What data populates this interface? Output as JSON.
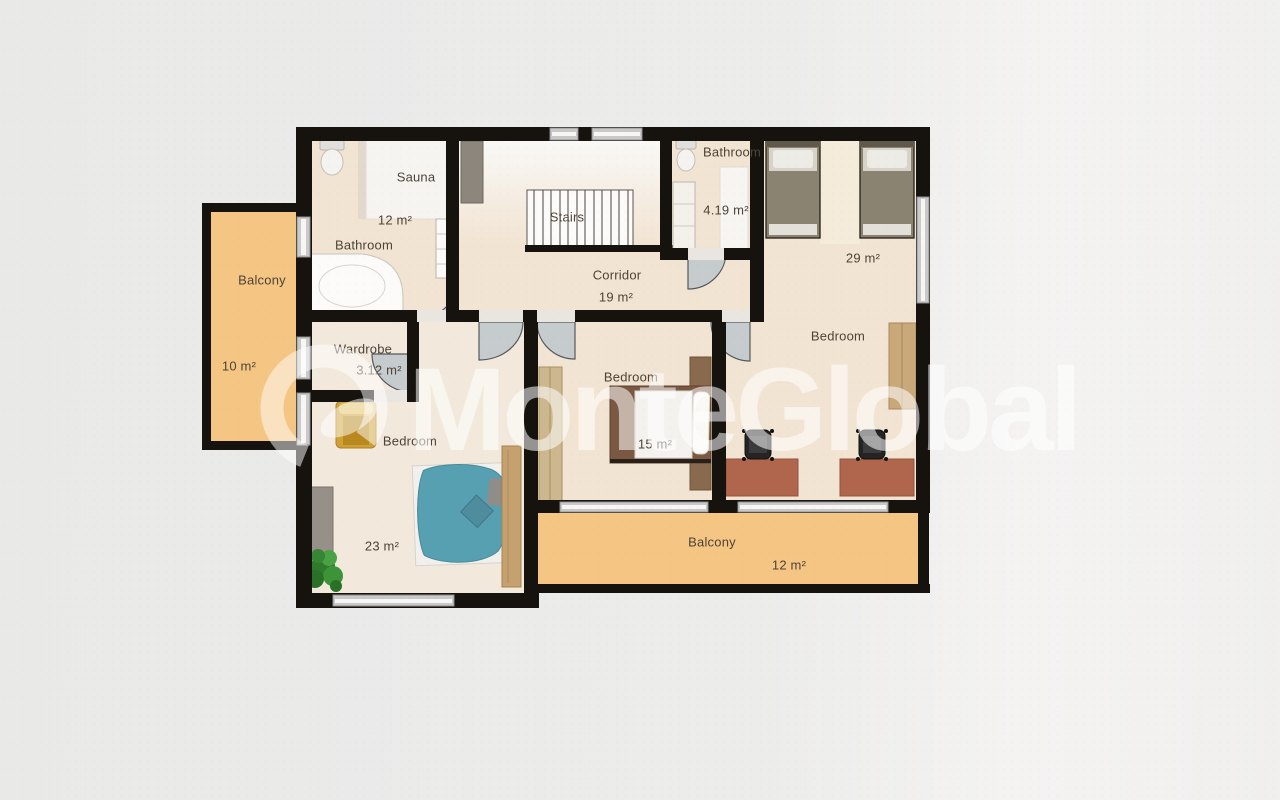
{
  "watermark": {
    "brand": "MonteGlobal"
  },
  "rooms": {
    "balcony_left": {
      "label": "Balcony",
      "area": "10 m²"
    },
    "bathroom_main": {
      "label": "Bathroom",
      "area": "12 m²"
    },
    "sauna": {
      "label": "Sauna"
    },
    "stairs": {
      "label": "Stairs"
    },
    "corridor": {
      "label": "Corridor",
      "area": "19 m²"
    },
    "bathroom_small": {
      "label": "Bathroom",
      "area": "4.19 m²"
    },
    "bedroom_large": {
      "label": "Bedroom",
      "area": "29 m²"
    },
    "wardrobe": {
      "label": "Wardrobe",
      "area": "3.12 m²"
    },
    "bedroom_left": {
      "label": "Bedroom",
      "area": "23 m²"
    },
    "bedroom_middle": {
      "label": "Bedroom",
      "area": "15 m²"
    },
    "balcony_bottom": {
      "label": "Balcony",
      "area": "12 m²"
    }
  },
  "colors": {
    "wall": "#16120e",
    "floor": "#f2e4d2",
    "balcony": "#f5c583",
    "window": "#c9c9c9",
    "door": "#c6cbce",
    "teal": "#57a0b2",
    "desk": "#b0664c",
    "bed_olive": "#8b8372",
    "wood": "#c5a170",
    "label": "#4d4437",
    "watermark": "rgba(255,255,255,0.55)"
  }
}
